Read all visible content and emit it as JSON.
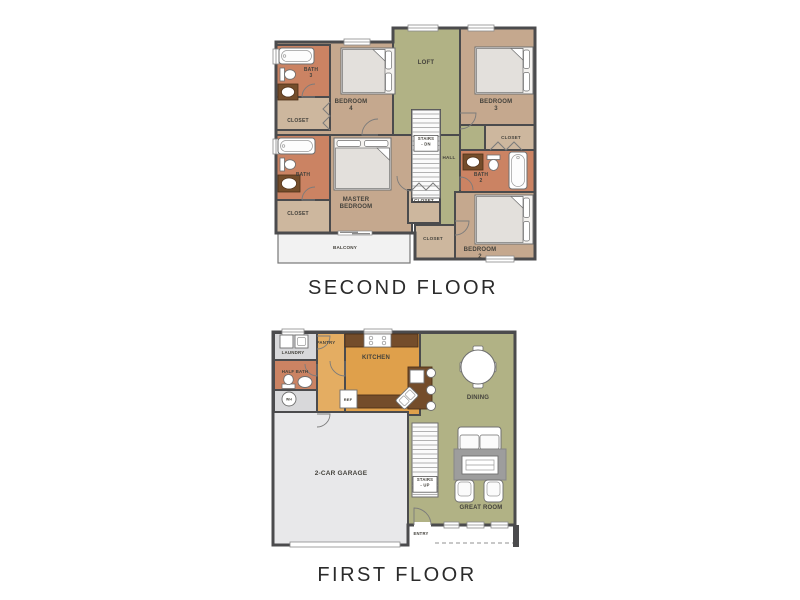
{
  "palette": {
    "wall": "#4b4b4d",
    "tan": "#c5a88e",
    "tanLight": "#cdb79e",
    "salmon": "#cb8363",
    "green": "#b1b285",
    "orange": "#dfa04b",
    "orangeLight": "#e4ad62",
    "brown": "#744d2b",
    "grayRoom": "#d8d8da",
    "garage": "#e8e8ea",
    "balcony": "#f2f2f2",
    "rug": "#9d9d9d",
    "label": "#44423c",
    "caption": "#2b2b2b"
  },
  "floors": [
    {
      "id": "second-floor",
      "caption": "SECOND FLOOR",
      "outline": "M 8 24 H 125 V 10 H 267 V 241 H 147 V 215 H 8 Z",
      "regions": [
        {
          "name": "bedroom-4",
          "x": 8,
          "y": 24,
          "w": 119,
          "h": 93,
          "fill": "tan"
        },
        {
          "name": "loft",
          "x": 125,
          "y": 10,
          "w": 67,
          "h": 107,
          "fill": "green"
        },
        {
          "name": "bedroom-3",
          "x": 192,
          "y": 10,
          "w": 75,
          "h": 97,
          "fill": "tan"
        },
        {
          "name": "hall",
          "x": 172,
          "y": 117,
          "w": 20,
          "h": 124,
          "fill": "green"
        },
        {
          "name": "hall-upper",
          "x": 192,
          "y": 107,
          "w": 25,
          "h": 25,
          "fill": "green"
        },
        {
          "name": "master-bedroom",
          "x": 62,
          "y": 117,
          "w": 82,
          "h": 98,
          "fill": "tan"
        },
        {
          "name": "bedroom-2",
          "x": 187,
          "y": 174,
          "w": 80,
          "h": 67,
          "fill": "tan"
        },
        {
          "name": "bath-2",
          "x": 192,
          "y": 132,
          "w": 75,
          "h": 42,
          "fill": "salmon"
        },
        {
          "name": "closet-bedroom-3",
          "x": 217,
          "y": 107,
          "w": 50,
          "h": 25,
          "fill": "tanLight"
        },
        {
          "name": "bath-3",
          "x": 8,
          "y": 27,
          "w": 54,
          "h": 52,
          "fill": "salmon"
        },
        {
          "name": "closet-bedroom-4",
          "x": 8,
          "y": 79,
          "w": 54,
          "h": 33,
          "fill": "tanLight"
        },
        {
          "name": "bath-master",
          "x": 8,
          "y": 117,
          "w": 54,
          "h": 65,
          "fill": "salmon"
        },
        {
          "name": "closet-master",
          "x": 8,
          "y": 182,
          "w": 54,
          "h": 33,
          "fill": "tanLight"
        },
        {
          "name": "closet-hall",
          "x": 140,
          "y": 172,
          "w": 32,
          "h": 33,
          "fill": "tanLight"
        },
        {
          "name": "closet-bedroom-2",
          "x": 147,
          "y": 207,
          "w": 40,
          "h": 34,
          "fill": "tanLight"
        },
        {
          "name": "stairwell",
          "x": 144,
          "y": 92,
          "w": 28,
          "h": 92,
          "fill": "white"
        },
        {
          "name": "balcony",
          "x": 10,
          "y": 215,
          "w": 132,
          "h": 30,
          "fill": "balcony",
          "thin": true
        }
      ],
      "windows": [
        {
          "x": 76,
          "y": 21,
          "w": 26,
          "h": 6,
          "orient": "h"
        },
        {
          "x": 140,
          "y": 7,
          "w": 30,
          "h": 6,
          "orient": "h"
        },
        {
          "x": 200,
          "y": 7,
          "w": 26,
          "h": 6,
          "orient": "h"
        },
        {
          "x": 5,
          "y": 31,
          "w": 6,
          "h": 15,
          "orient": "v"
        },
        {
          "x": 5,
          "y": 121,
          "w": 6,
          "h": 15,
          "orient": "v"
        },
        {
          "x": 218,
          "y": 238,
          "w": 28,
          "h": 6,
          "orient": "h"
        }
      ],
      "furniture": [
        {
          "type": "tub",
          "x": 11,
          "y": 30,
          "w": 35,
          "h": 16,
          "orient": "h"
        },
        {
          "type": "toilet",
          "x": 12,
          "y": 50,
          "dir": "e"
        },
        {
          "type": "vanity",
          "x": 10,
          "y": 66,
          "w": 20,
          "h": 16
        },
        {
          "type": "bed",
          "x": 73,
          "y": 30,
          "w": 54,
          "h": 46,
          "pillows": "right"
        },
        {
          "type": "bed",
          "x": 207,
          "y": 29,
          "w": 58,
          "h": 47,
          "pillows": "right"
        },
        {
          "type": "tub",
          "x": 10,
          "y": 120,
          "w": 37,
          "h": 16,
          "orient": "h"
        },
        {
          "type": "toilet",
          "x": 12,
          "y": 140,
          "dir": "e"
        },
        {
          "type": "vanity",
          "x": 10,
          "y": 157,
          "w": 22,
          "h": 17
        },
        {
          "type": "bed",
          "x": 66,
          "y": 120,
          "w": 57,
          "h": 52,
          "pillows": "top"
        },
        {
          "type": "vanity",
          "x": 195,
          "y": 136,
          "w": 20,
          "h": 16
        },
        {
          "type": "toilet",
          "x": 219,
          "y": 137,
          "dir": "s"
        },
        {
          "type": "tub",
          "x": 241,
          "y": 134,
          "w": 18,
          "h": 37,
          "orient": "v"
        },
        {
          "type": "bed",
          "x": 207,
          "y": 177,
          "w": 58,
          "h": 49,
          "pillows": "right"
        },
        {
          "type": "stairs",
          "x": 144,
          "y": 92,
          "w": 28,
          "h": 88
        },
        {
          "type": "slider",
          "x": 70,
          "y": 213,
          "w": 34
        }
      ],
      "doors": [
        {
          "hx": 110,
          "hy": 117,
          "r": 16,
          "a1": 180,
          "a2": 270
        },
        {
          "hx": 192,
          "hy": 95,
          "r": 16,
          "a1": 0,
          "a2": 90
        },
        {
          "hx": 144,
          "hy": 158,
          "r": 15,
          "a1": 90,
          "a2": 180
        },
        {
          "hx": 187,
          "hy": 203,
          "r": 14,
          "a1": 0,
          "a2": 90
        },
        {
          "hx": 47,
          "hy": 79,
          "r": 13,
          "a1": 180,
          "a2": 270
        },
        {
          "hx": 47,
          "hy": 182,
          "r": 13,
          "a1": 180,
          "a2": 270
        },
        {
          "hx": 192,
          "hy": 172,
          "r": 13,
          "a1": 270,
          "a2": 360
        }
      ],
      "zigzags": [
        "M 222 132 L 230 124 L 238 132 L 246 124 L 254 132",
        "M 62 84 L 55 91 L 62 98 L 55 105 L 62 112",
        "M 144 172 L 151 165 L 158 172 L 165 165 L 172 172"
      ],
      "labels": [
        {
          "name": "bath-3",
          "lines": [
            "BATH",
            "3"
          ],
          "x": 43,
          "y": 53,
          "size": 5
        },
        {
          "name": "closet-bedroom-4",
          "lines": [
            "CLOSET"
          ],
          "x": 30,
          "y": 104,
          "size": 5
        },
        {
          "name": "bedroom-4",
          "lines": [
            "BEDROOM",
            "4"
          ],
          "x": 83,
          "y": 85,
          "size": 6
        },
        {
          "name": "loft",
          "lines": [
            "LOFT"
          ],
          "x": 158,
          "y": 46,
          "size": 6
        },
        {
          "name": "bedroom-3",
          "lines": [
            "BEDROOM",
            "3"
          ],
          "x": 228,
          "y": 85,
          "size": 6
        },
        {
          "name": "closet-bedroom-3",
          "lines": [
            "CLOSET"
          ],
          "x": 243,
          "y": 121,
          "size": 4.6
        },
        {
          "name": "stairs-dn",
          "lines": [
            "STAIRS",
            "- DN"
          ],
          "x": 158,
          "y": 122,
          "size": 4.2,
          "box": true
        },
        {
          "name": "hall",
          "lines": [
            "HALL"
          ],
          "x": 181,
          "y": 141,
          "size": 4.6
        },
        {
          "name": "bath-2",
          "lines": [
            "BATH",
            "2"
          ],
          "x": 213,
          "y": 158,
          "size": 5
        },
        {
          "name": "master-bedroom",
          "lines": [
            "MASTER",
            "BEDROOM"
          ],
          "x": 88,
          "y": 183,
          "size": 6
        },
        {
          "name": "bath-master",
          "lines": [
            "BATH"
          ],
          "x": 35,
          "y": 158,
          "size": 5
        },
        {
          "name": "closet-master",
          "lines": [
            "CLOSET"
          ],
          "x": 30,
          "y": 197,
          "size": 5
        },
        {
          "name": "closet-hall",
          "lines": [
            "CLOSET"
          ],
          "x": 156,
          "y": 184,
          "size": 4.6
        },
        {
          "name": "closet-bedroom-2",
          "lines": [
            "CLOSET"
          ],
          "x": 165,
          "y": 222,
          "size": 4.6
        },
        {
          "name": "bedroom-2",
          "lines": [
            "BEDROOM",
            "2"
          ],
          "x": 212,
          "y": 233,
          "size": 6
        },
        {
          "name": "balcony",
          "lines": [
            "BALCONY"
          ],
          "x": 77,
          "y": 231,
          "size": 4.6
        }
      ]
    },
    {
      "id": "first-floor",
      "caption": "FIRST FLOOR",
      "outline": "M 5 4 H 247 V 197 H 140 V 217 H 5 Z",
      "regions": [
        {
          "name": "living-green",
          "x": 140,
          "y": 5,
          "w": 107,
          "h": 192,
          "fill": "green"
        },
        {
          "name": "hallway",
          "x": 49,
          "y": 5,
          "w": 28,
          "h": 83,
          "fill": "orangeLight"
        },
        {
          "name": "kitchen",
          "x": 77,
          "y": 5,
          "w": 75,
          "h": 82,
          "fill": "orange"
        },
        {
          "name": "laundry",
          "x": 6,
          "y": 5,
          "w": 43,
          "h": 27,
          "fill": "grayRoom"
        },
        {
          "name": "half-bath",
          "x": 6,
          "y": 32,
          "w": 43,
          "h": 30,
          "fill": "salmon"
        },
        {
          "name": "wh-room",
          "x": 6,
          "y": 62,
          "w": 43,
          "h": 26,
          "fill": "grayRoom"
        },
        {
          "name": "garage",
          "x": 5,
          "y": 84,
          "w": 135,
          "h": 133,
          "fill": "garage"
        }
      ],
      "windows": [
        {
          "x": 14,
          "y": 1,
          "w": 22,
          "h": 6,
          "orient": "h"
        },
        {
          "x": 96,
          "y": 1,
          "w": 28,
          "h": 6,
          "orient": "h"
        },
        {
          "x": 176,
          "y": 194,
          "w": 15,
          "h": 6,
          "orient": "h"
        },
        {
          "x": 199,
          "y": 194,
          "w": 17,
          "h": 6,
          "orient": "h"
        },
        {
          "x": 223,
          "y": 194,
          "w": 17,
          "h": 6,
          "orient": "h"
        },
        {
          "x": 146,
          "y": 194,
          "w": 17,
          "h": 6,
          "orient": "h",
          "gap": true
        }
      ],
      "furniture": [
        {
          "type": "counter",
          "x": 77,
          "y": 6,
          "w": 73,
          "h": 13
        },
        {
          "type": "stove",
          "x": 96,
          "y": 6,
          "w": 27,
          "h": 13
        },
        {
          "type": "counter",
          "x": 89,
          "y": 67,
          "w": 51,
          "h": 13
        },
        {
          "type": "counter",
          "x": 140,
          "y": 39,
          "w": 24,
          "h": 42
        },
        {
          "type": "box",
          "x": 142,
          "y": 42,
          "w": 14,
          "h": 13,
          "name": "island-prep-sink"
        },
        {
          "type": "islandsink",
          "cx": 139,
          "cy": 70,
          "rot": -45
        },
        {
          "type": "stool",
          "cx": 163,
          "cy": 45
        },
        {
          "type": "stool",
          "cx": 163,
          "cy": 62
        },
        {
          "type": "stool",
          "cx": 163,
          "cy": 78
        },
        {
          "type": "box",
          "x": 72,
          "y": 62,
          "w": 17,
          "h": 18,
          "name": "refrigerator"
        },
        {
          "type": "appliance",
          "x": 12,
          "y": 7,
          "w": 13,
          "h": 13,
          "inner": false
        },
        {
          "type": "appliance",
          "x": 27,
          "y": 7,
          "w": 13,
          "h": 13,
          "inner": true
        },
        {
          "type": "toilet",
          "x": 14,
          "y": 47,
          "dir": "n"
        },
        {
          "type": "sink",
          "cx": 37,
          "cy": 54,
          "rx": 7,
          "ry": 5.5
        },
        {
          "type": "whc",
          "cx": 21,
          "cy": 71,
          "r": 7
        },
        {
          "type": "table-round",
          "cx": 210,
          "cy": 39,
          "r": 17
        },
        {
          "type": "sofa",
          "x": 190,
          "y": 99,
          "w": 43,
          "h": 25
        },
        {
          "type": "rug",
          "x": 186,
          "y": 121,
          "w": 52,
          "h": 31
        },
        {
          "type": "ctable",
          "x": 194,
          "y": 128,
          "w": 36,
          "h": 18
        },
        {
          "type": "armchair",
          "x": 187,
          "y": 152,
          "w": 19,
          "h": 22
        },
        {
          "type": "armchair",
          "x": 216,
          "y": 152,
          "w": 19,
          "h": 22
        },
        {
          "type": "stairs",
          "x": 144,
          "y": 95,
          "w": 26,
          "h": 74
        },
        {
          "type": "gdoor",
          "x": 22,
          "y": 214,
          "w": 110
        },
        {
          "type": "post",
          "x": 245,
          "y": 197,
          "w": 6,
          "h": 22
        },
        {
          "type": "dash",
          "x1": 167,
          "y1": 215,
          "x2": 245,
          "y2": 215
        }
      ],
      "doors": [
        {
          "hx": 146,
          "hy": 197,
          "r": 17,
          "a1": 270,
          "a2": 360
        },
        {
          "hx": 77,
          "hy": 33,
          "r": 15,
          "a1": 90,
          "a2": 180
        },
        {
          "hx": 49,
          "hy": 86,
          "r": 13,
          "a1": 0,
          "a2": 90
        },
        {
          "hx": 49,
          "hy": 36,
          "r": 12,
          "a1": 90,
          "a2": 180
        },
        {
          "hx": 49,
          "hy": 8,
          "r": 13,
          "a1": 0,
          "a2": 90
        }
      ],
      "zigzags": [],
      "labels": [
        {
          "name": "laundry",
          "lines": [
            "LAUNDRY"
          ],
          "x": 25,
          "y": 26,
          "size": 4.4
        },
        {
          "name": "pantry",
          "lines": [
            "PANTRY"
          ],
          "x": 58,
          "y": 16,
          "size": 4.4
        },
        {
          "name": "kitchen",
          "lines": [
            "KITCHEN"
          ],
          "x": 108,
          "y": 31,
          "size": 6
        },
        {
          "name": "half-bath",
          "lines": [
            "HALF BATH"
          ],
          "x": 27,
          "y": 45,
          "size": 4.4
        },
        {
          "name": "wh",
          "lines": [
            "WH"
          ],
          "x": 21,
          "y": 72.5,
          "size": 3.4
        },
        {
          "name": "ref",
          "lines": [
            "REF"
          ],
          "x": 80,
          "y": 73,
          "size": 4
        },
        {
          "name": "dining",
          "lines": [
            "DINING"
          ],
          "x": 210,
          "y": 71,
          "size": 6
        },
        {
          "name": "stairs-up",
          "lines": [
            "STAIRS",
            "- UP"
          ],
          "x": 157,
          "y": 153,
          "size": 4.2,
          "box": true
        },
        {
          "name": "great-room",
          "lines": [
            "GREAT ROOM"
          ],
          "x": 213,
          "y": 181,
          "size": 6
        },
        {
          "name": "entry",
          "lines": [
            "ENTRY"
          ],
          "x": 153,
          "y": 207,
          "size": 4.2
        },
        {
          "name": "garage",
          "lines": [
            "2-CAR GARAGE"
          ],
          "x": 73,
          "y": 147,
          "size": 6.5
        }
      ]
    }
  ]
}
